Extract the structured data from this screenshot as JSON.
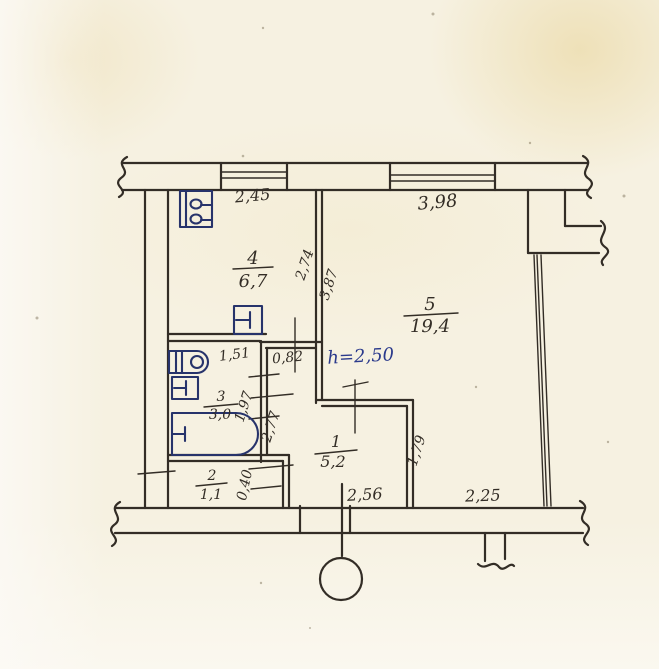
{
  "colors": {
    "paper": "#f6f1e1",
    "wall_ink": "#332d26",
    "fixture_ink": "#27336b",
    "height_note_ink": "#2b3a8c"
  },
  "rooms": {
    "r1": {
      "number": "1",
      "area": "5,2"
    },
    "r2": {
      "number": "2",
      "area": "1,1"
    },
    "r3": {
      "number": "3",
      "area": "3,0"
    },
    "r4": {
      "number": "4",
      "area": "6,7"
    },
    "r5": {
      "number": "5",
      "area": "19,4"
    }
  },
  "ceiling_height": "h=2,50",
  "dimensions": {
    "room4_width": "2,45",
    "room5_width": "3,98",
    "room4_depth": "2,74",
    "room5_depth": "3,87",
    "bath_width": "1,51",
    "niche_width": "0,82",
    "bath_depth": "1,97",
    "corridor_depth": "2,77",
    "duct_width": "0,40",
    "corridor_width": "2,56",
    "room5_lower_width": "2,25",
    "room5_lower_depth": "1,79"
  }
}
